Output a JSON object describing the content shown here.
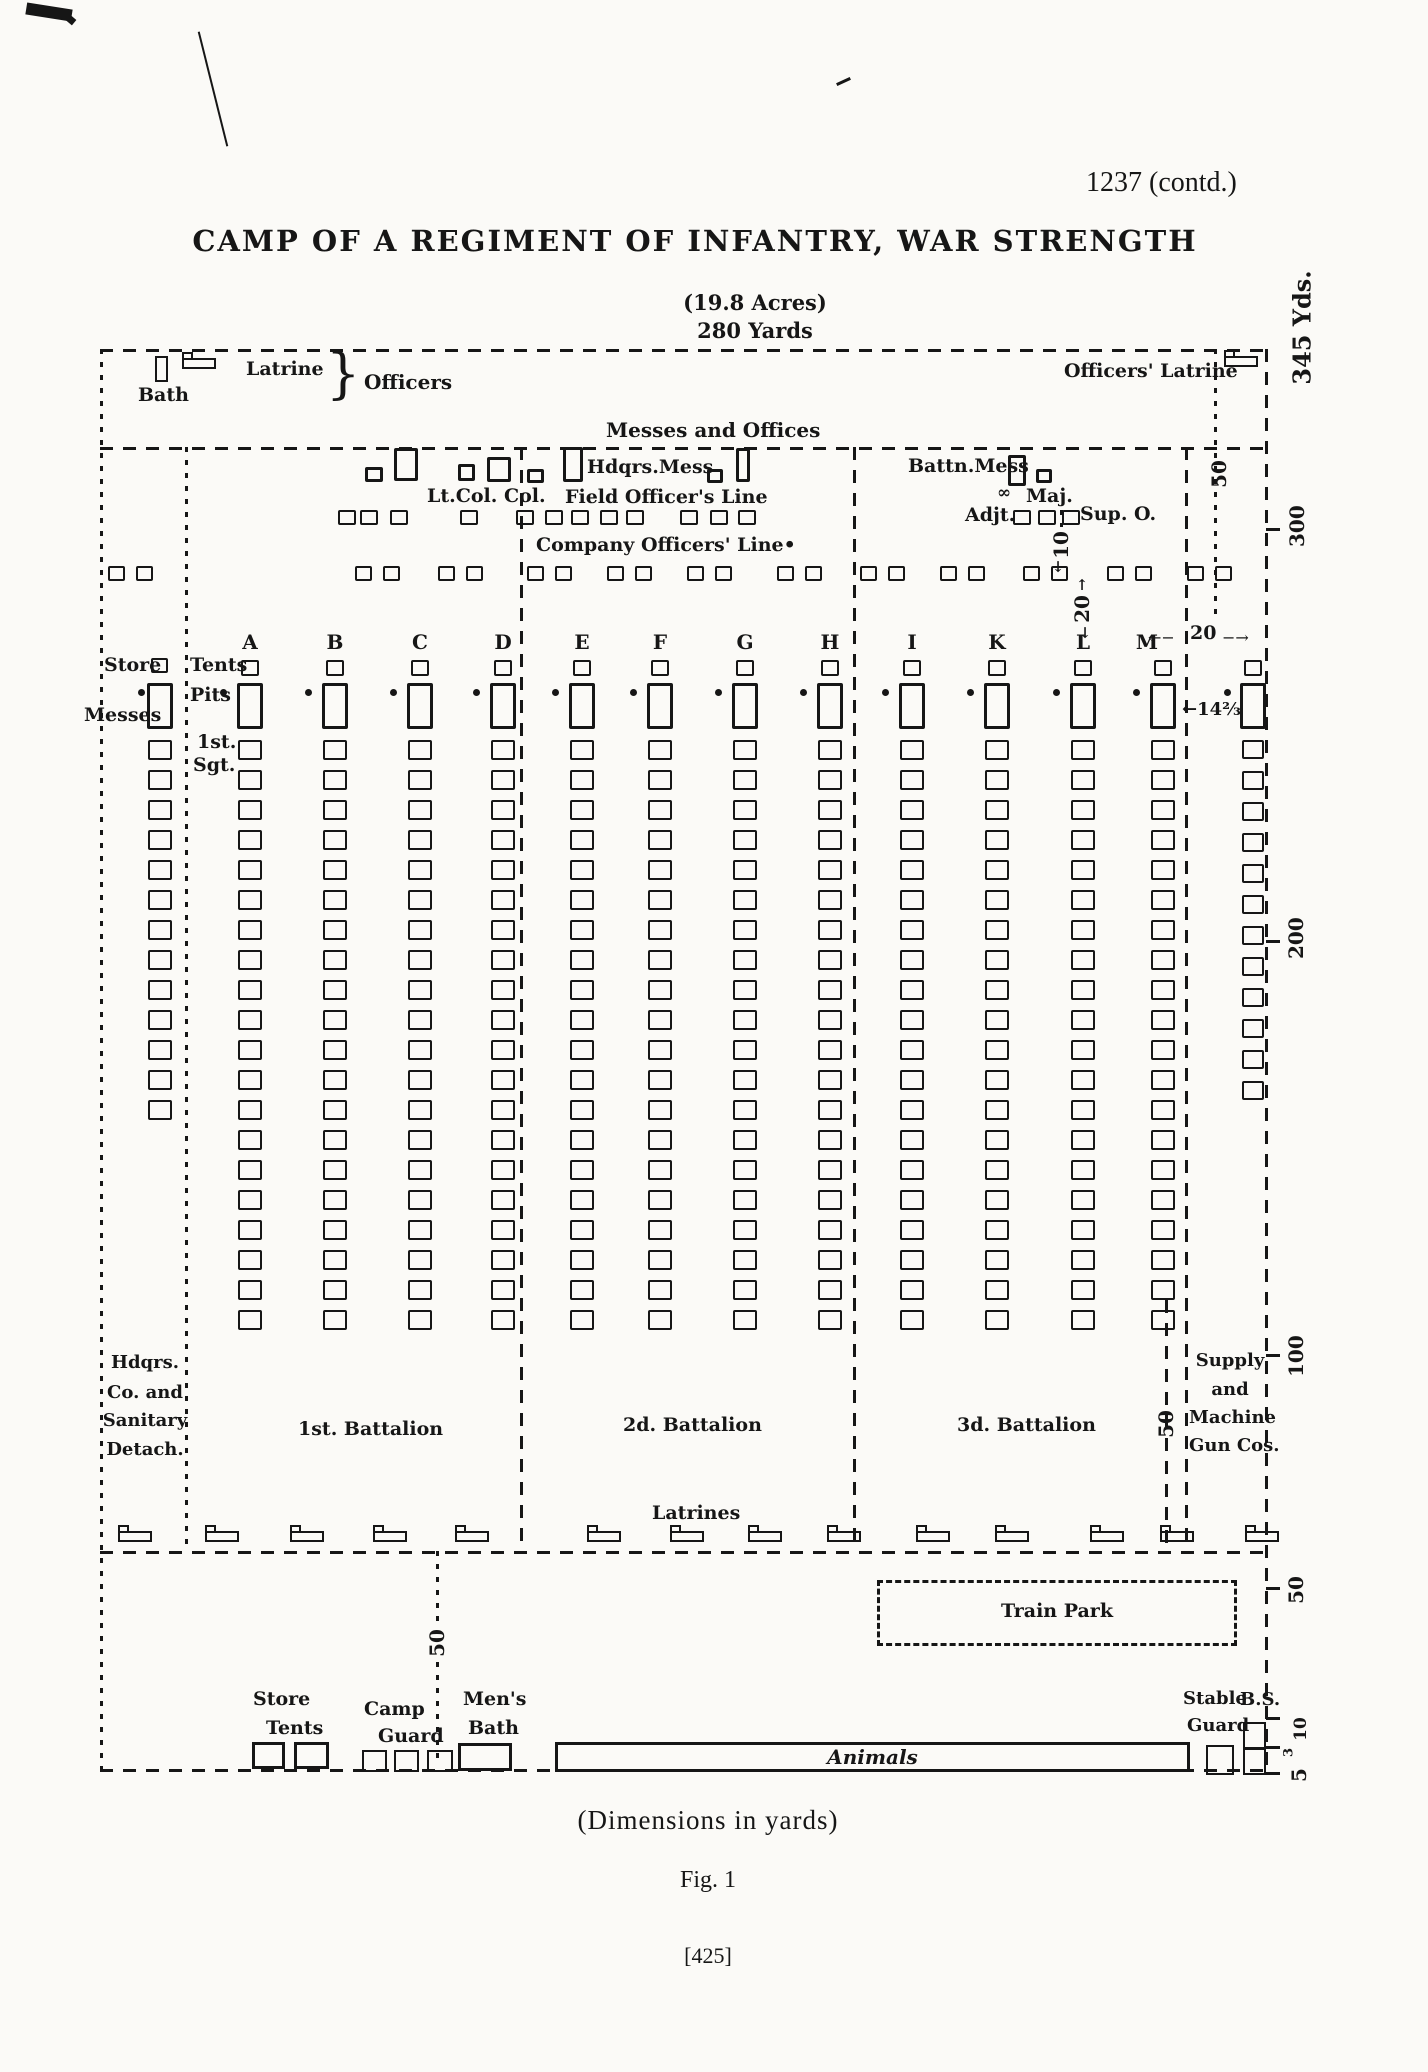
{
  "page": {
    "doc_ref": "1237 (contd.)",
    "title": "CAMP OF A REGIMENT OF INFANTRY, WAR STRENGTH",
    "acres": "(19.8 Acres)",
    "top_width": "280 Yards",
    "dimensions_note": "(Dimensions in yards)",
    "figure_caption": "Fig. 1",
    "page_number": "[425]"
  },
  "top_strip": {
    "bath": "Bath",
    "latrine": "Latrine",
    "brace": "}",
    "officers": "Officers",
    "officers_latrine": "Officers' Latrine"
  },
  "offices": {
    "header": "Messes and Offices",
    "hdqrs_mess": "Hdqrs.Mess",
    "lt_col_col": "Lt.Col. Col.",
    "field_officers_line": "Field Officer's Line",
    "company_officers_line": "Company Officers' Line•",
    "battn_mess": "Battn.Mess",
    "maj_glyph": "∞",
    "maj": "Maj.",
    "adjt": "Adjt.",
    "sup_o": "Sup. O."
  },
  "left_labels": {
    "store": "Store",
    "tents": "Tents",
    "pits": "Pits",
    "messes": "Messes",
    "first_sgt_line1": "1st.",
    "first_sgt_line2": "Sgt."
  },
  "companies": {
    "letters": [
      "A",
      "B",
      "C",
      "D",
      "E",
      "F",
      "G",
      "H",
      "I",
      "K",
      "L",
      "M"
    ],
    "street_tent_count": 20,
    "store_column_tent_count": 13,
    "supply_column_tent_count": 12
  },
  "battalions": {
    "first": "1st. Battalion",
    "second": "2d. Battalion",
    "third": "3d. Battalion"
  },
  "sections": {
    "hdqrs_co_lines": [
      "Hdqrs.",
      "Co. and",
      "Sanitary",
      "Detach."
    ],
    "supply_lines": [
      "Supply",
      "and",
      "Machine",
      "Gun Cos."
    ]
  },
  "bottom": {
    "latrines": "Latrines",
    "train_park": "Train Park",
    "store_tents_line1": "Store",
    "store_tents_line2": "Tents",
    "camp_guard_line1": "Camp",
    "camp_guard_line2": "Guard",
    "mens_bath_line1": "Men's",
    "mens_bath_line2": "Bath",
    "animals": "Animals",
    "stable_guard_line1": "Stable",
    "stable_guard_line2": "Guard",
    "bs": "B.S."
  },
  "dimension_labels": {
    "strip_50": "50",
    "ten": "10",
    "twenty_vertical": "20",
    "twenty_horizontal": "20",
    "arrow_left": "←−",
    "arrow_right": "−→",
    "arrow_up": "↑",
    "arrow_down": "↓",
    "tent_width": "←14⅔",
    "supply_50": "50",
    "guard_50": "50"
  },
  "scale": {
    "total": "345 Yds.",
    "y300": "300",
    "y200": "200",
    "y100": "100",
    "y50": "50",
    "y10": "10",
    "y3": "3",
    "y5": "5"
  },
  "ink": "#161616"
}
